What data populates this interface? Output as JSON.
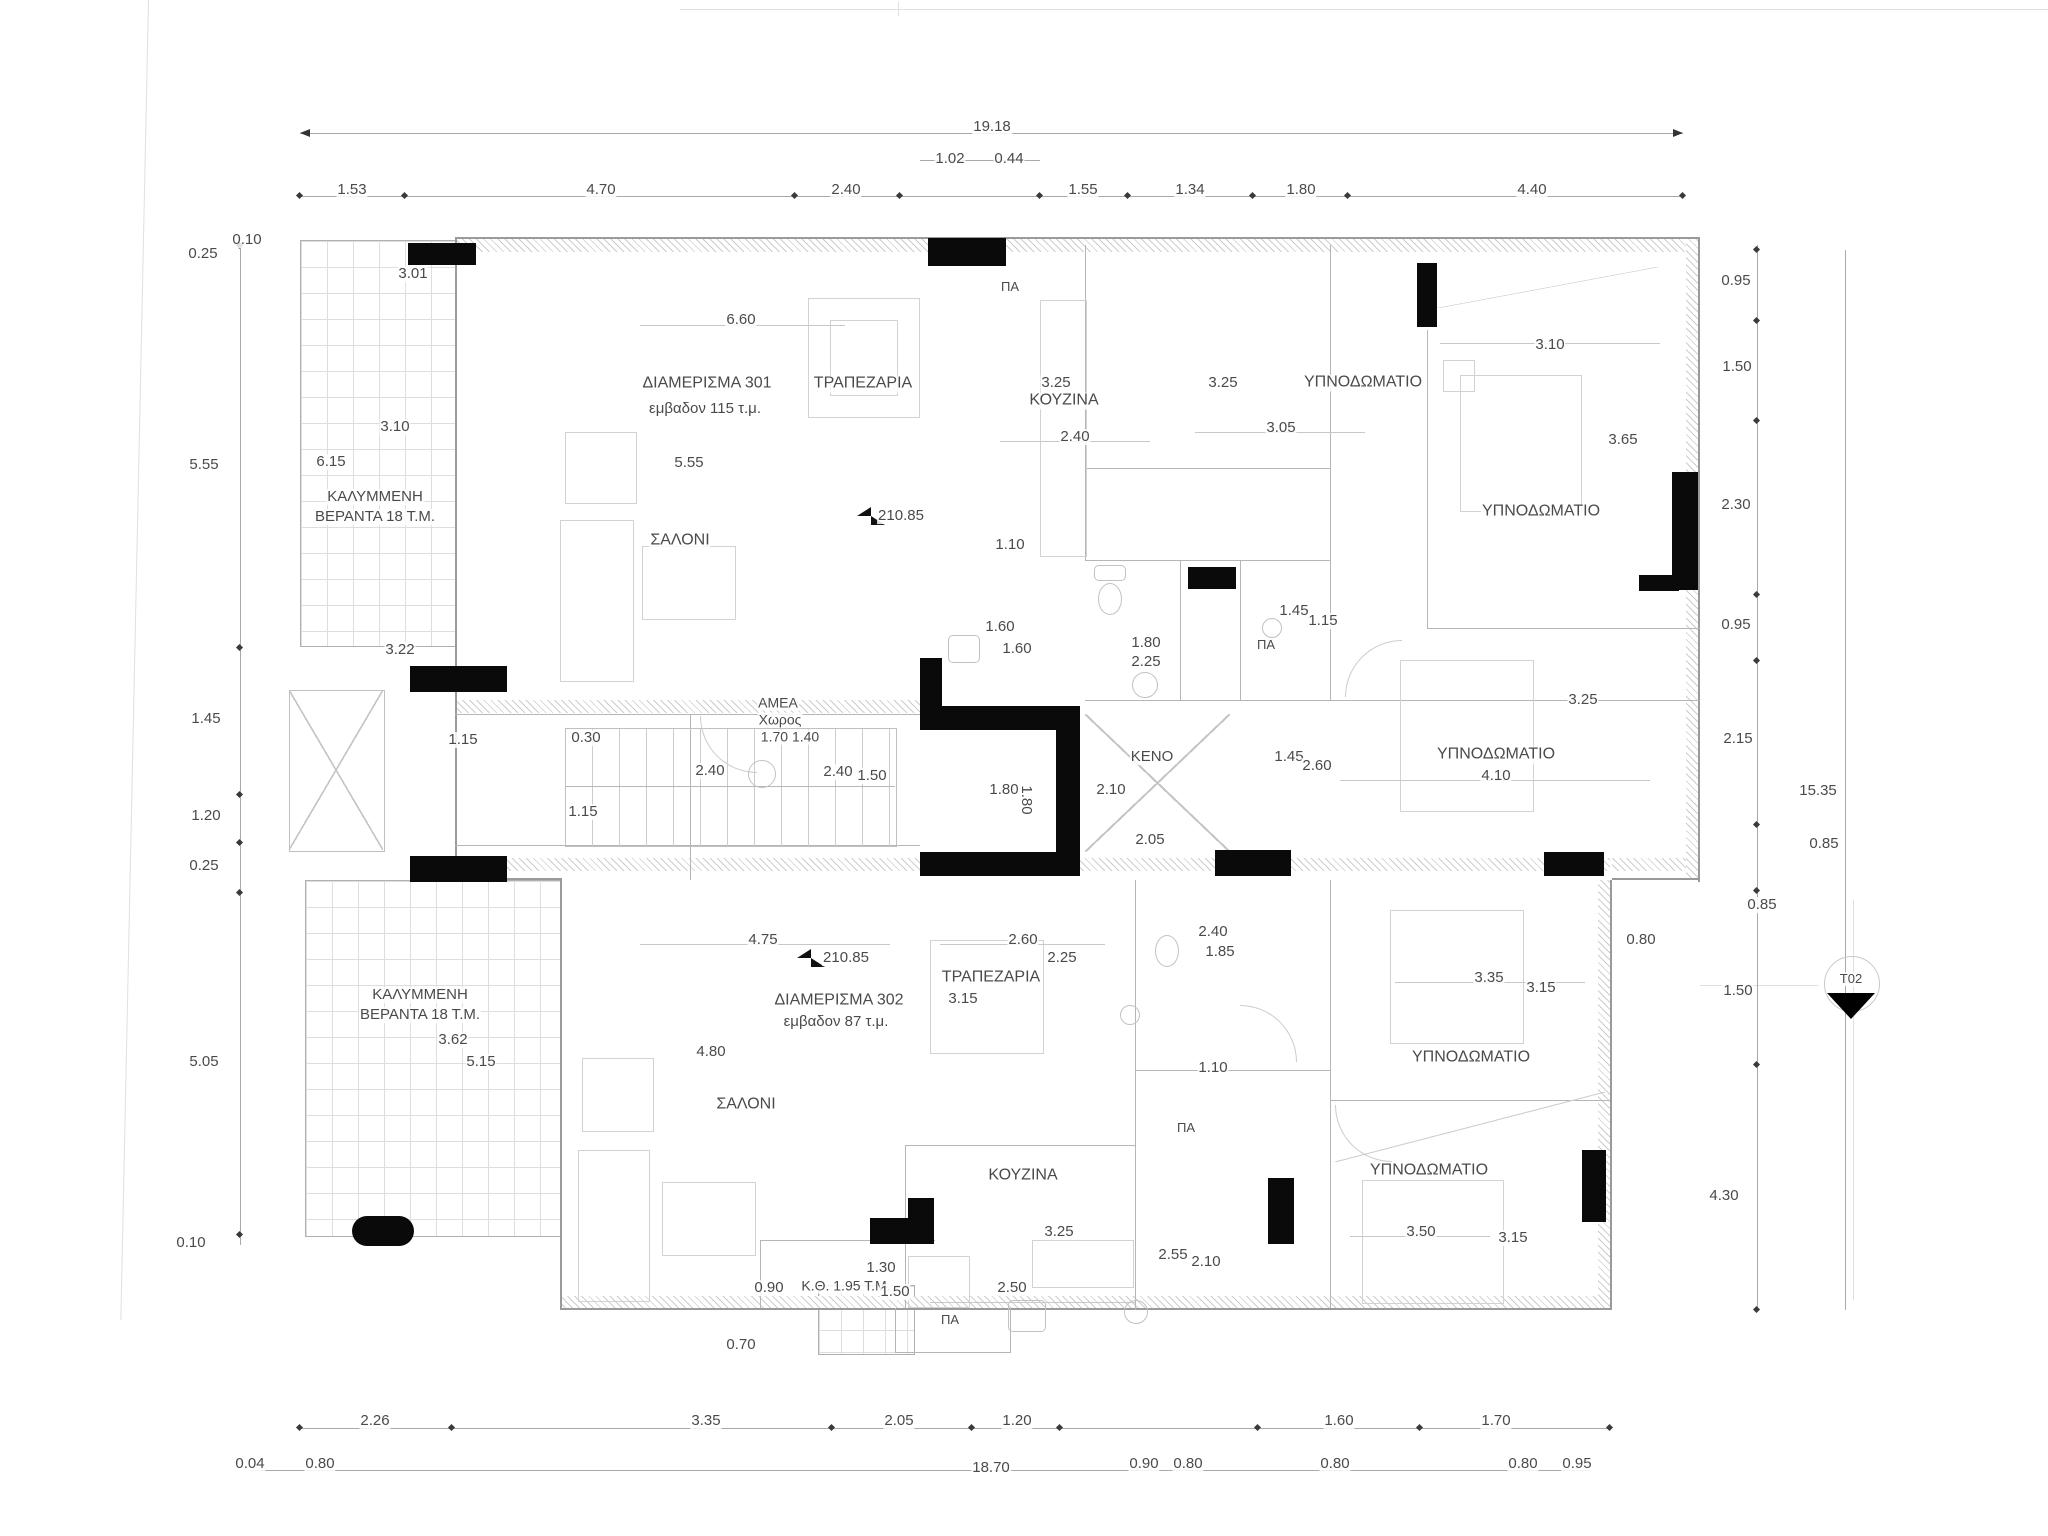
{
  "colors": {
    "ink": "#0a0a0a",
    "wall_line": "#b6b6b6",
    "text": "#4a4a4a"
  },
  "plan": {
    "apartments": [
      {
        "name": "ΔΙΑΜΕΡΙΣΜΑ 301",
        "area": "εμβαδον 115 τ.μ."
      },
      {
        "name": "ΔΙΑΜΕΡΙΣΜΑ 302",
        "area": "εμβαδον 87 τ.μ."
      }
    ],
    "rooms": [
      "ΤΡΑΠΕΖΑΡΙΑ",
      "ΚΟΥΖΙΝΑ",
      "ΥΠΝΟΔΩΜΑΤΙΟ",
      "ΣΑΛΟΝΙ",
      "ΚΕΝΟ",
      "ΑΜΕΑ Χωρος",
      "ΚΑΛΥΜΜΕΝΗ ΒΕΡΑΝΤΑ 18 Τ.Μ.",
      "Κ.Θ. 1.95 Τ.Μ."
    ],
    "level_marker": "210.85",
    "section_marker": "T02",
    "overall_dimensions": {
      "top": "19.18",
      "bottom": "18.70",
      "right_total": "15.35"
    },
    "labels": [
      {
        "t": "19.18",
        "x": 992,
        "y": 127
      },
      {
        "t": "1.02",
        "x": 950,
        "y": 159
      },
      {
        "t": "0.44",
        "x": 1009,
        "y": 159
      },
      {
        "t": "1.53",
        "x": 352,
        "y": 190
      },
      {
        "t": "4.70",
        "x": 601,
        "y": 190
      },
      {
        "t": "2.40",
        "x": 846,
        "y": 190
      },
      {
        "t": "1.55",
        "x": 1083,
        "y": 190
      },
      {
        "t": "1.34",
        "x": 1190,
        "y": 190
      },
      {
        "t": "1.80",
        "x": 1301,
        "y": 190
      },
      {
        "t": "4.40",
        "x": 1532,
        "y": 190
      },
      {
        "t": "0.25",
        "x": 203,
        "y": 254
      },
      {
        "t": "0.10",
        "x": 247,
        "y": 240
      },
      {
        "t": "5.55",
        "x": 204,
        "y": 465
      },
      {
        "t": "1.45",
        "x": 206,
        "y": 719
      },
      {
        "t": "1.20",
        "x": 206,
        "y": 816
      },
      {
        "t": "0.25",
        "x": 204,
        "y": 866
      },
      {
        "t": "5.05",
        "x": 204,
        "y": 1062
      },
      {
        "t": "0.10",
        "x": 191,
        "y": 1243
      },
      {
        "t": "0.95",
        "x": 1736,
        "y": 281
      },
      {
        "t": "1.50",
        "x": 1737,
        "y": 367
      },
      {
        "t": "2.30",
        "x": 1736,
        "y": 505
      },
      {
        "t": "0.95",
        "x": 1736,
        "y": 625
      },
      {
        "t": "2.15",
        "x": 1738,
        "y": 739
      },
      {
        "t": "15.35",
        "x": 1818,
        "y": 791
      },
      {
        "t": "0.85",
        "x": 1824,
        "y": 844
      },
      {
        "t": "0.85",
        "x": 1762,
        "y": 905
      },
      {
        "t": "1.50",
        "x": 1738,
        "y": 991
      },
      {
        "t": "4.30",
        "x": 1724,
        "y": 1196
      },
      {
        "t": "2.26",
        "x": 375,
        "y": 1421
      },
      {
        "t": "3.35",
        "x": 706,
        "y": 1421
      },
      {
        "t": "2.05",
        "x": 899,
        "y": 1421
      },
      {
        "t": "1.20",
        "x": 1017,
        "y": 1421
      },
      {
        "t": "1.60",
        "x": 1339,
        "y": 1421
      },
      {
        "t": "1.70",
        "x": 1496,
        "y": 1421
      },
      {
        "t": "0.04",
        "x": 250,
        "y": 1464
      },
      {
        "t": "0.80",
        "x": 320,
        "y": 1464
      },
      {
        "t": "18.70",
        "x": 991,
        "y": 1468
      },
      {
        "t": "0.90",
        "x": 1144,
        "y": 1464
      },
      {
        "t": "0.80",
        "x": 1188,
        "y": 1464
      },
      {
        "t": "0.80",
        "x": 1335,
        "y": 1464
      },
      {
        "t": "0.80",
        "x": 1523,
        "y": 1464
      },
      {
        "t": "0.95",
        "x": 1577,
        "y": 1464
      },
      {
        "t": "3.01",
        "x": 413,
        "y": 274
      },
      {
        "t": "6.60",
        "x": 741,
        "y": 320
      },
      {
        "t": "ΔΙΑΜΕΡΙΣΜΑ 301",
        "x": 707,
        "y": 384,
        "fs": 16
      },
      {
        "t": "εμβαδον 115 τ.μ.",
        "x": 705,
        "y": 409
      },
      {
        "t": "ΤΡΑΠΕΖΑΡΙΑ",
        "x": 863,
        "y": 384,
        "fs": 16
      },
      {
        "t": "3.25",
        "x": 1056,
        "y": 383
      },
      {
        "t": "ΚΟΥΖΙΝΑ",
        "x": 1064,
        "y": 401,
        "fs": 16
      },
      {
        "t": "3.25",
        "x": 1223,
        "y": 383
      },
      {
        "t": "ΥΠΝΟΔΩΜΑΤΙΟ",
        "x": 1363,
        "y": 383,
        "fs": 16
      },
      {
        "t": "2.40",
        "x": 1075,
        "y": 437
      },
      {
        "t": "3.05",
        "x": 1281,
        "y": 428
      },
      {
        "t": "3.10",
        "x": 1550,
        "y": 345
      },
      {
        "t": "3.10",
        "x": 395,
        "y": 427
      },
      {
        "t": "6.15",
        "x": 331,
        "y": 462
      },
      {
        "t": "5.55",
        "x": 689,
        "y": 463
      },
      {
        "t": "3.65",
        "x": 1623,
        "y": 440
      },
      {
        "t": "ΚΑΛΥΜΜΕΝΗ",
        "x": 375,
        "y": 497
      },
      {
        "t": "ΒΕΡΑΝΤΑ 18 Τ.Μ.",
        "x": 375,
        "y": 517
      },
      {
        "t": "ΥΠΝΟΔΩΜΑΤΙΟ",
        "x": 1541,
        "y": 512,
        "fs": 16
      },
      {
        "t": "ΣΑΛΟΝΙ",
        "x": 680,
        "y": 541,
        "fs": 16
      },
      {
        "t": "210.85",
        "x": 901,
        "y": 516
      },
      {
        "t": "1.10",
        "x": 1010,
        "y": 545
      },
      {
        "t": "1.60",
        "x": 1000,
        "y": 627
      },
      {
        "t": "1.60",
        "x": 1017,
        "y": 649
      },
      {
        "t": "1.45",
        "x": 1294,
        "y": 611
      },
      {
        "t": "1.15",
        "x": 1323,
        "y": 621
      },
      {
        "t": "ΠΑ",
        "x": 1266,
        "y": 645,
        "fs": 13
      },
      {
        "t": "1.80",
        "x": 1146,
        "y": 643
      },
      {
        "t": "2.25",
        "x": 1146,
        "y": 662
      },
      {
        "t": "3.22",
        "x": 400,
        "y": 650
      },
      {
        "t": "ΑΜΕΑ",
        "x": 778,
        "y": 703,
        "fs": 14
      },
      {
        "t": "Χωρος",
        "x": 780,
        "y": 720,
        "fs": 14
      },
      {
        "t": "1.70 1.40",
        "x": 790,
        "y": 737,
        "fs": 14
      },
      {
        "t": "1.15",
        "x": 463,
        "y": 740
      },
      {
        "t": "0.30",
        "x": 586,
        "y": 738
      },
      {
        "t": "2.40",
        "x": 710,
        "y": 771
      },
      {
        "t": "2.40",
        "x": 838,
        "y": 772
      },
      {
        "t": "1.50",
        "x": 872,
        "y": 776
      },
      {
        "t": "1.15",
        "x": 583,
        "y": 812
      },
      {
        "t": "1.80",
        "x": 1004,
        "y": 790
      },
      {
        "t": "1.80",
        "x": 1026,
        "y": 800,
        "rot": 90
      },
      {
        "t": "ΚΕΝΟ",
        "x": 1152,
        "y": 757
      },
      {
        "t": "2.10",
        "x": 1111,
        "y": 790
      },
      {
        "t": "1.45",
        "x": 1289,
        "y": 757
      },
      {
        "t": "2.60",
        "x": 1317,
        "y": 766
      },
      {
        "t": "ΥΠΝΟΔΩΜΑΤΙΟ",
        "x": 1496,
        "y": 755,
        "fs": 16
      },
      {
        "t": "4.10",
        "x": 1496,
        "y": 776
      },
      {
        "t": "3.25",
        "x": 1583,
        "y": 700
      },
      {
        "t": "2.05",
        "x": 1150,
        "y": 840
      },
      {
        "t": "ΠΑ",
        "x": 1010,
        "y": 287,
        "fs": 13
      },
      {
        "t": "4.75",
        "x": 763,
        "y": 940
      },
      {
        "t": "210.85",
        "x": 846,
        "y": 958
      },
      {
        "t": "2.60",
        "x": 1023,
        "y": 940
      },
      {
        "t": "2.25",
        "x": 1062,
        "y": 958
      },
      {
        "t": "ΤΡΑΠΕΖΑΡΙΑ",
        "x": 991,
        "y": 978,
        "fs": 16
      },
      {
        "t": "3.15",
        "x": 963,
        "y": 999
      },
      {
        "t": "2.40",
        "x": 1213,
        "y": 932
      },
      {
        "t": "1.85",
        "x": 1220,
        "y": 952
      },
      {
        "t": "ΔΙΑΜΕΡΙΣΜΑ 302",
        "x": 839,
        "y": 1001,
        "fs": 16
      },
      {
        "t": "εμβαδον 87 τ.μ.",
        "x": 836,
        "y": 1022
      },
      {
        "t": "0.80",
        "x": 1641,
        "y": 940
      },
      {
        "t": "3.35",
        "x": 1489,
        "y": 978
      },
      {
        "t": "3.15",
        "x": 1541,
        "y": 988
      },
      {
        "t": "ΚΑΛΥΜΜΕΝΗ",
        "x": 420,
        "y": 995
      },
      {
        "t": "ΒΕΡΑΝΤΑ 18 Τ.Μ.",
        "x": 420,
        "y": 1015
      },
      {
        "t": "3.62",
        "x": 453,
        "y": 1040
      },
      {
        "t": "5.15",
        "x": 481,
        "y": 1062
      },
      {
        "t": "4.80",
        "x": 711,
        "y": 1052
      },
      {
        "t": "ΥΠΝΟΔΩΜΑΤΙΟ",
        "x": 1471,
        "y": 1058,
        "fs": 16
      },
      {
        "t": "1.10",
        "x": 1213,
        "y": 1068
      },
      {
        "t": "ΣΑΛΟΝΙ",
        "x": 746,
        "y": 1105,
        "fs": 16
      },
      {
        "t": "ΠΑ",
        "x": 1186,
        "y": 1128,
        "fs": 13
      },
      {
        "t": "ΚΟΥΖΙΝΑ",
        "x": 1023,
        "y": 1176,
        "fs": 16
      },
      {
        "t": "ΥΠΝΟΔΩΜΑΤΙΟ",
        "x": 1429,
        "y": 1171,
        "fs": 16
      },
      {
        "t": "3.25",
        "x": 1059,
        "y": 1232
      },
      {
        "t": "2.55",
        "x": 1173,
        "y": 1255
      },
      {
        "t": "2.10",
        "x": 1206,
        "y": 1262
      },
      {
        "t": "3.50",
        "x": 1421,
        "y": 1232
      },
      {
        "t": "3.15",
        "x": 1513,
        "y": 1238
      },
      {
        "t": "1.30",
        "x": 881,
        "y": 1268
      },
      {
        "t": "0.90",
        "x": 769,
        "y": 1288
      },
      {
        "t": "Κ.Θ. 1.95 Τ.Μ.",
        "x": 846,
        "y": 1286,
        "fs": 14
      },
      {
        "t": "1.50",
        "x": 895,
        "y": 1292
      },
      {
        "t": "2.50",
        "x": 1012,
        "y": 1288
      },
      {
        "t": "ΠΑ",
        "x": 950,
        "y": 1320,
        "fs": 13
      },
      {
        "t": "0.70",
        "x": 741,
        "y": 1345
      },
      {
        "t": "T02",
        "x": 1851,
        "y": 979,
        "fs": 13
      }
    ]
  }
}
